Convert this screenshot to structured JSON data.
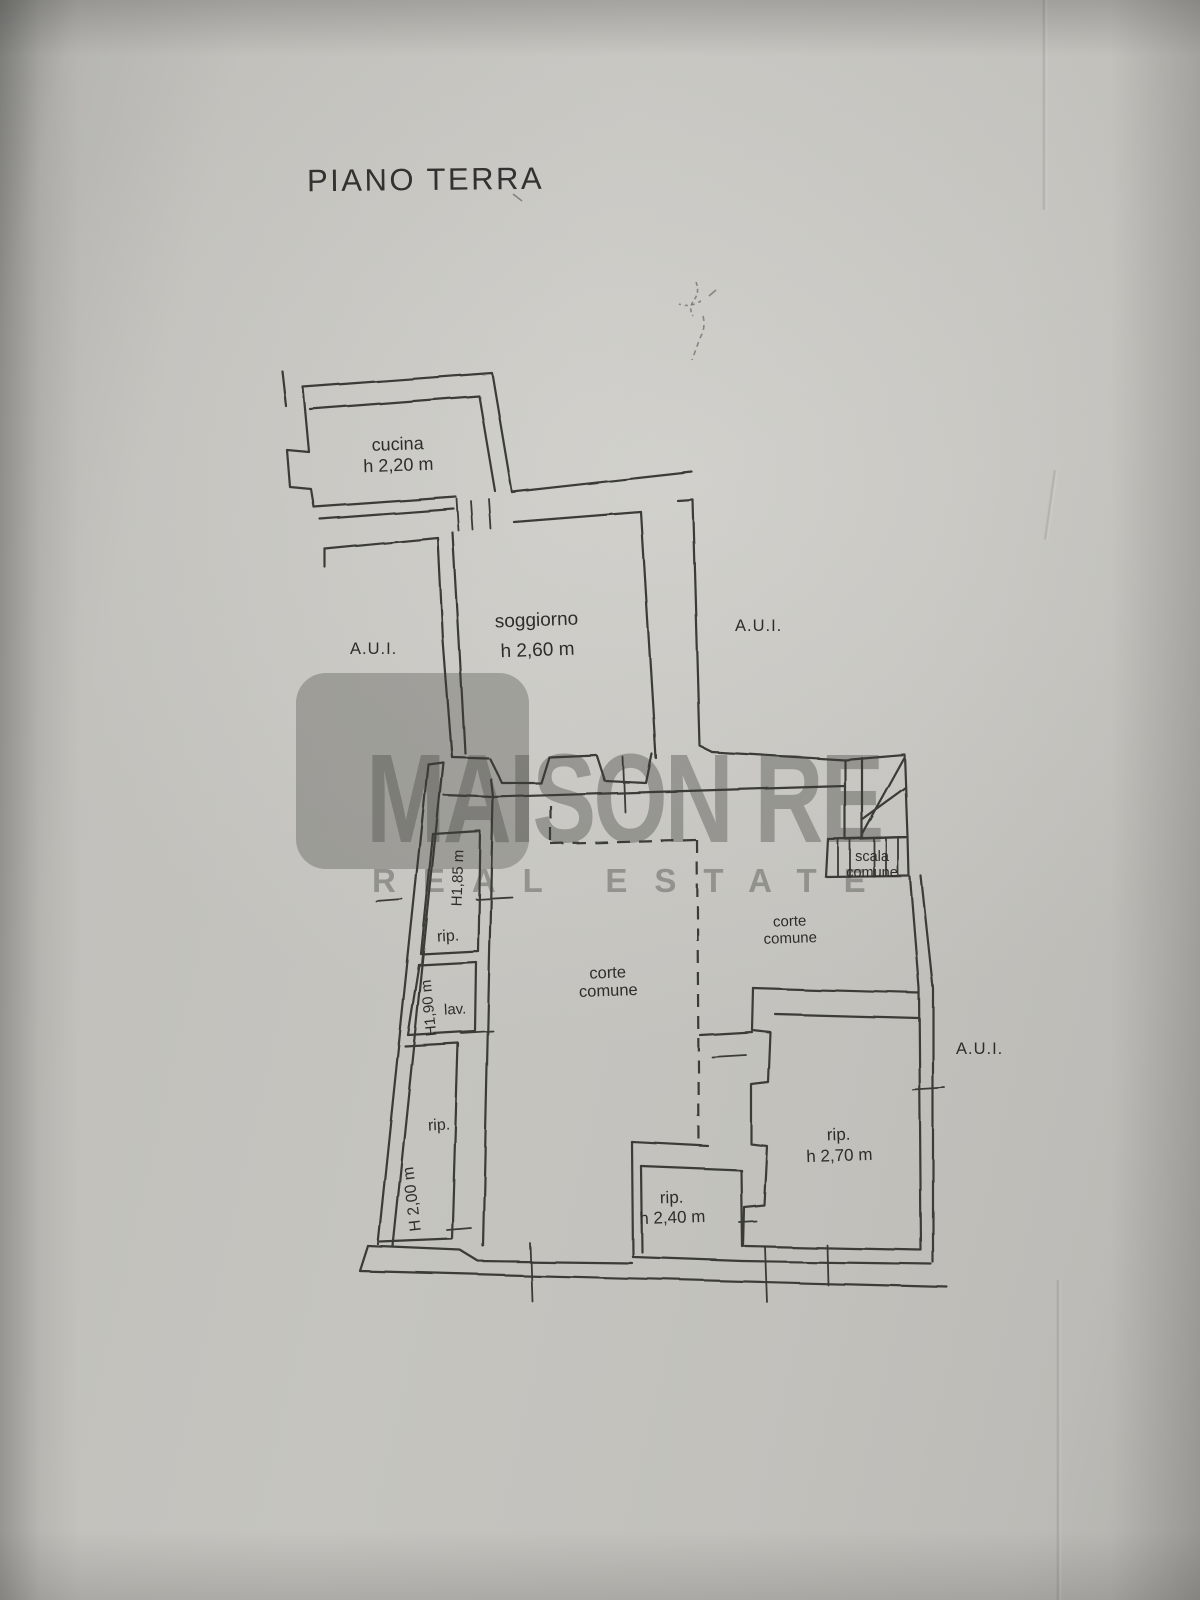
{
  "page": {
    "title": "PIANO TERRA"
  },
  "watermark": {
    "line1": "MAISON RE",
    "line2": "REAL ESTATE",
    "color": "#55554F"
  },
  "colors": {
    "paper": "#C9C8C3",
    "ink": "#3A3A37"
  },
  "rooms": {
    "cucina": {
      "label": "cucina",
      "height": "h 2,20 m"
    },
    "soggiorno": {
      "label": "soggiorno",
      "height": "h 2,60 m"
    },
    "rip_top": {
      "label": "rip.",
      "height": "H1,85 m"
    },
    "lav": {
      "label": "lav.",
      "height": "H1,90 m"
    },
    "rip_left": {
      "label": "rip.",
      "height": "H 2,00 m"
    },
    "rip_center": {
      "label": "rip.",
      "height": "h 2,40 m"
    },
    "rip_right": {
      "label": "rip.",
      "height": "h 2,70 m"
    }
  },
  "areas": {
    "corte_center": "corte comune",
    "corte_right": "corte comune",
    "scala": "scala comune",
    "aui_left": "A.U.I.",
    "aui_mid": "A.U.I.",
    "aui_right": "A.U.I."
  }
}
